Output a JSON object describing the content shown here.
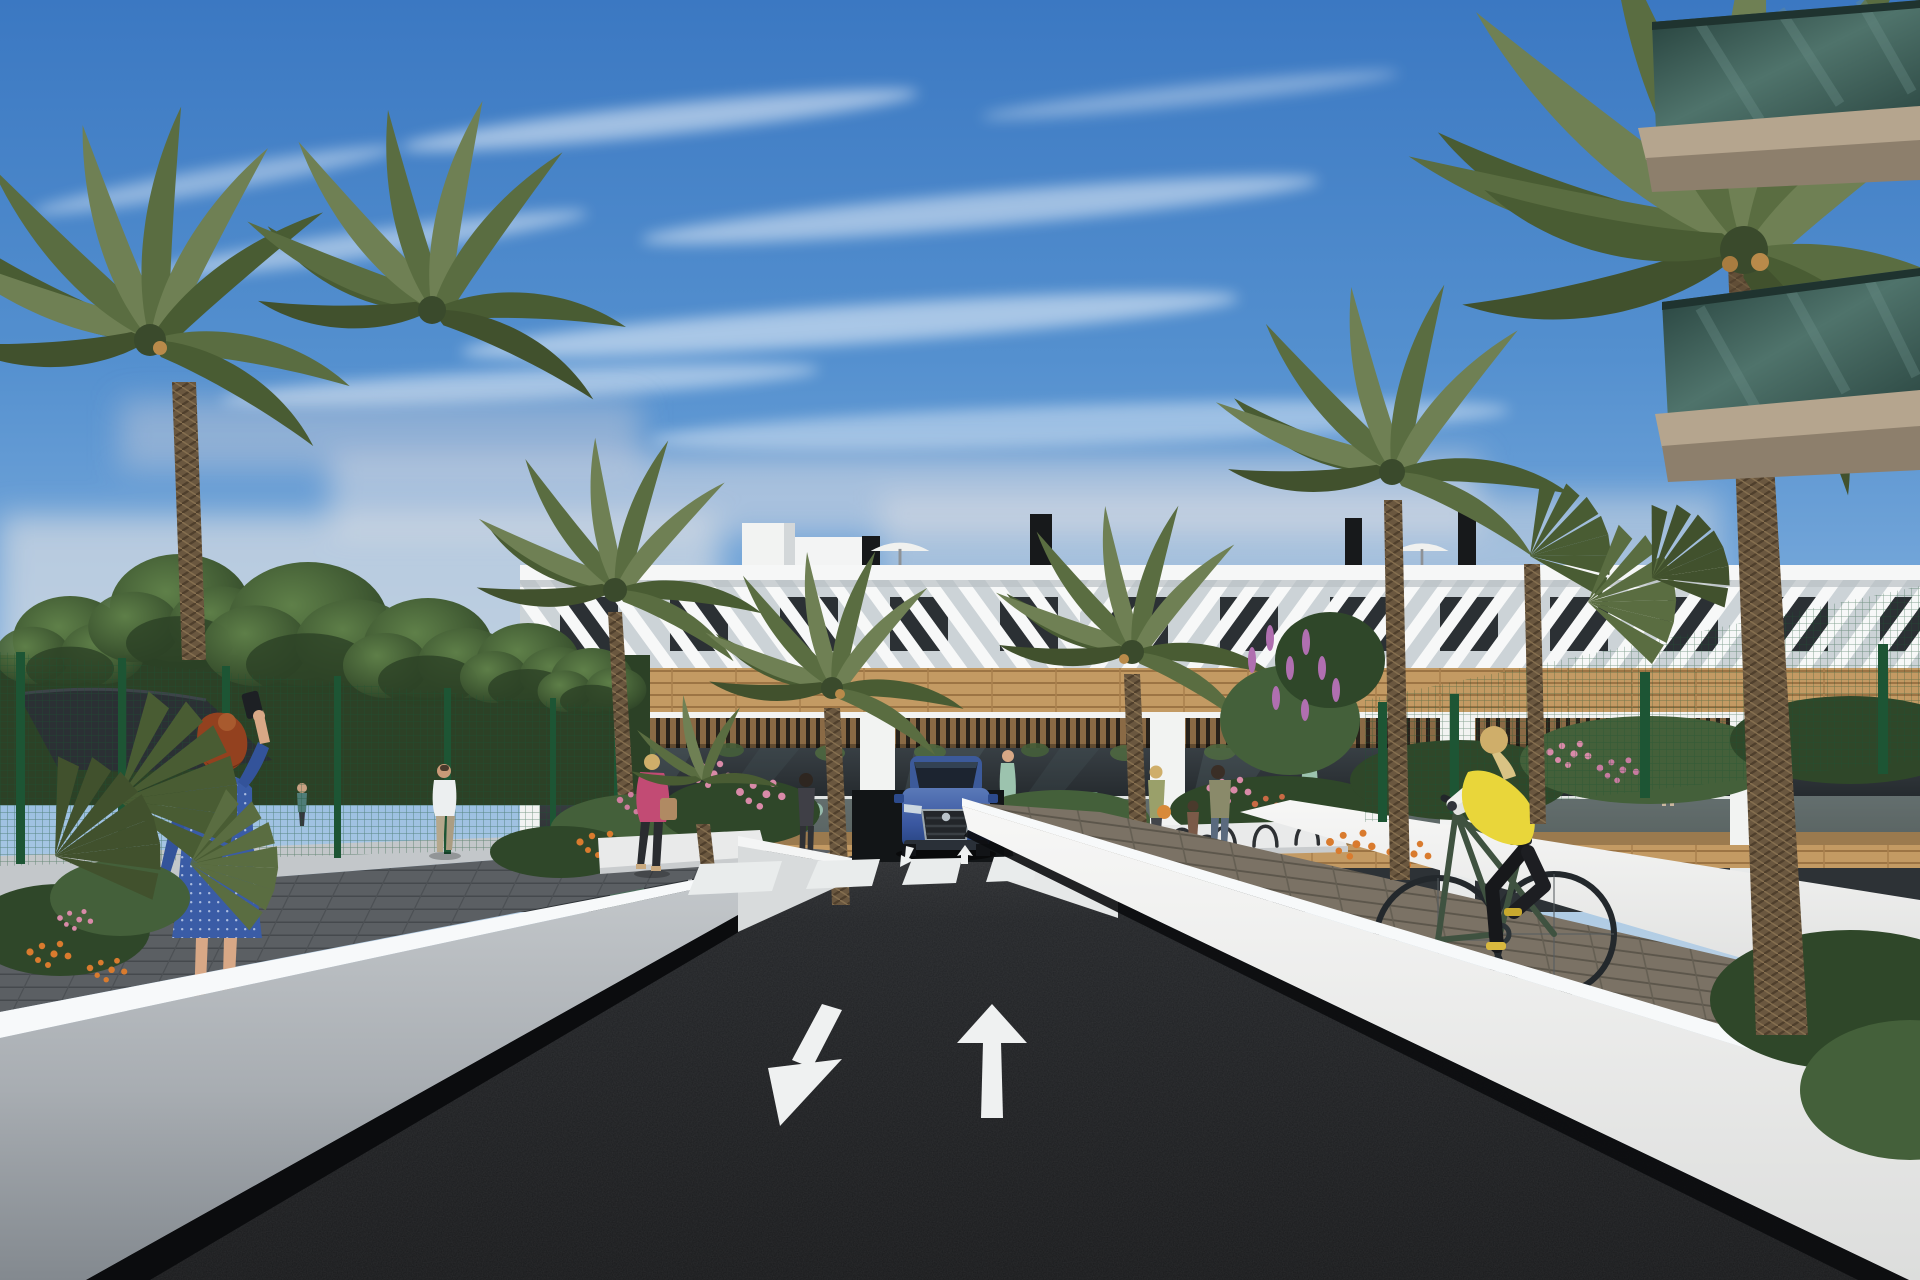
{
  "scene": {
    "type": "architectural-3d-render",
    "description": "Street-level daytime rendering of a modern white Mediterranean apartment complex with wood accents, palm trees, gardens, pedestrians, a cyclist and a blue SUV exiting an underground garage ramp",
    "sky": {
      "condition": "blue with wispy clouds and light horizon haze"
    },
    "road": {
      "surface": "dark asphalt",
      "lane_arrows": [
        "down-left",
        "up"
      ],
      "ramp_arrows": [
        "down",
        "up"
      ],
      "crosswalk_stripes": 7
    },
    "building": {
      "floors": 3,
      "features": [
        "white louvered attic band",
        "wood plank bands",
        "pergola balconies",
        "glass balustrades",
        "roof terrace with umbrellas and chimneys",
        "underground garage ramp"
      ],
      "balcony_contents": [
        "dining table with chairs",
        "standing figures"
      ]
    },
    "right_foreground_building": {
      "features": [
        "green glass balconies",
        "tan concrete slabs"
      ]
    },
    "vehicles": [
      {
        "kind": "suv",
        "color_name": "blue",
        "location": "garage ramp, facing viewer"
      }
    ],
    "people": [
      {
        "id": "woman-blue-dress",
        "detail": "red-haired woman in blue dotted dress raising phone, left sidewalk"
      },
      {
        "id": "man-white-tshirt",
        "detail": "man walking away along left fence"
      },
      {
        "id": "distant-person",
        "detail": "small distant figure inside fenced yard"
      },
      {
        "id": "woman-pink-jacket",
        "detail": "blonde woman in pink jacket with tan handbag crossing garden path"
      },
      {
        "id": "woman-dark-top",
        "detail": "woman standing by entrance planter"
      },
      {
        "id": "woman-shoulder-bag",
        "detail": "woman with orange bag near bike racks"
      },
      {
        "id": "mother-and-child",
        "detail": "adult with child near bike racks"
      },
      {
        "id": "balcony-couple",
        "detail": "two residents on first-floor balcony behind fence"
      },
      {
        "id": "cyclist",
        "detail": "blonde cyclist in yellow vest riding dark green bike on right paver walk"
      }
    ],
    "vegetation": [
      "date palms",
      "fan palms",
      "leafy trees",
      "hedges",
      "pink, orange and purple flowers"
    ],
    "street_furniture": [
      "black shade sail",
      "green mesh fences",
      "bike racks",
      "white retaining walls"
    ]
  },
  "palette": {
    "sky_top": "#3b78c2",
    "sky_horizon": "#d7dde1",
    "cloud": "#ffffff",
    "building_white": "#f2f3f2",
    "building_shade": "#ccd3d7",
    "wood": "#c39a63",
    "pergola_wood": "#8a6a45",
    "window_dark": "#2b3034",
    "balcony_glass": "#b9cdc6",
    "roof_item_dark": "#17191b",
    "road": "#212225",
    "road_marking": "#eff1f1",
    "wall_lit": "#f5f6f5",
    "wall_shaded": "#9aa0a5",
    "wall_top": "#f7f9fa",
    "sidewalk_left": "#5b5f63",
    "sidewalk_right": "#7b7265",
    "fence_green": "#1d5534",
    "sail": "#2b3034",
    "palm_trunk": "#6a573f",
    "car_blue": "#3f5fa5",
    "vest_yellow": "#e9d63a",
    "jacket_pink": "#c24b74",
    "dress_blue": "#3a5ca6",
    "hair_red": "#93411f",
    "hair_blonde": "#cfae6a",
    "skin": "#d8a886",
    "flower_pink": "#d98aa8",
    "flower_orange": "#d97b2e",
    "flower_purple": "#b06fb0",
    "glass_green": "#2e4a44",
    "slab_tan": "#b5a58e"
  }
}
